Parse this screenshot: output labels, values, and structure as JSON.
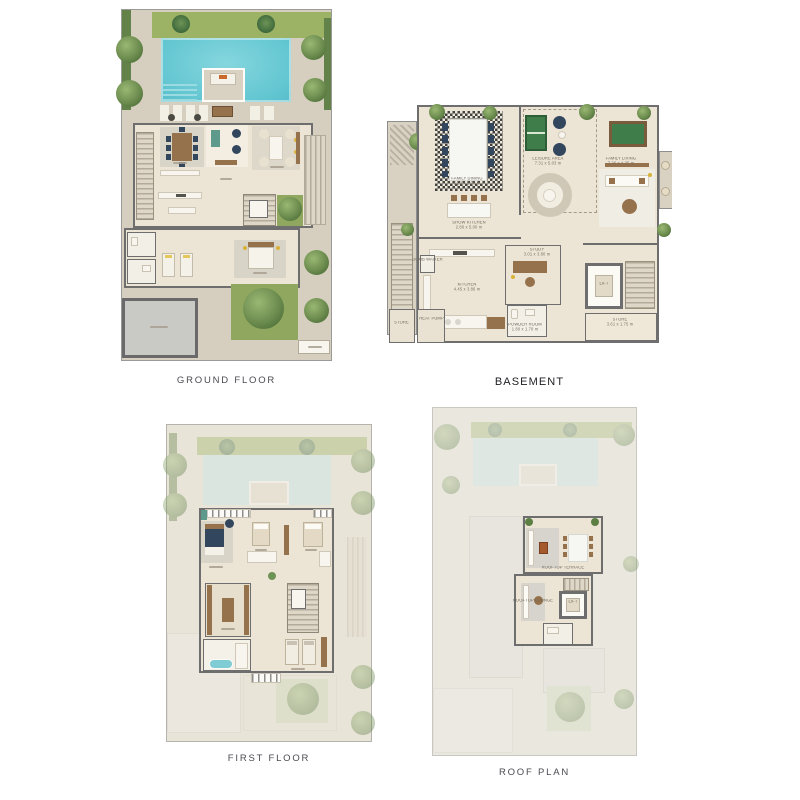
{
  "plans": {
    "ground_floor": {
      "title": "GROUND FLOOR"
    },
    "basement": {
      "title": "BASEMENT",
      "rooms": [
        {
          "name": "FAMILY DINING",
          "dims": "5.20 x 5.00 m"
        },
        {
          "name": "SHOW KITCHEN",
          "dims": "2.80 x 5.00 m"
        },
        {
          "name": "LEISURE AREA",
          "dims": "7.31 x 5.03 m"
        },
        {
          "name": "FAMILY LIVING",
          "dims": "7.26 x 4.35 m"
        },
        {
          "name": "STUDY",
          "dims": "3.01 x 3.80 m"
        },
        {
          "name": "KITCHEN",
          "dims": "4.45 x 3.86 m"
        },
        {
          "name": "POWDER ROOM",
          "dims": "1.80 x 1.70 m"
        },
        {
          "name": "LIFT",
          "dims": ""
        },
        {
          "name": "STORE",
          "dims": "3.61 x 1.75 m"
        },
        {
          "name": "STORE",
          "dims": ""
        },
        {
          "name": "HEAT PUMP",
          "dims": ""
        },
        {
          "name": "DUMB WAITER",
          "dims": ""
        }
      ]
    },
    "first_floor": {
      "title": "FIRST FLOOR"
    },
    "roof": {
      "title": "ROOF PLAN",
      "rooms": [
        {
          "name": "ROOFTOP TERRACE",
          "dims": ""
        },
        {
          "name": "ROOFTOP LOUNGE",
          "dims": ""
        },
        {
          "name": "LIFT",
          "dims": ""
        }
      ]
    }
  },
  "colors": {
    "background": "#ffffff",
    "pool_water": "#6fccd6",
    "pool_water_ghost": "#c5e8ec",
    "lawn": "#9cb365",
    "tree_foliage": "#5c7f44",
    "hardscape": "#d6cfbf",
    "interior_floor": "#ece4d4",
    "wall": "#6e6e6e",
    "garage_floor": "#c9c9c5",
    "pool_table_felt": "#3f7d4a",
    "accent_navy": "#32475e",
    "accent_wood": "#96724c",
    "label_text": "#4a4a50"
  }
}
